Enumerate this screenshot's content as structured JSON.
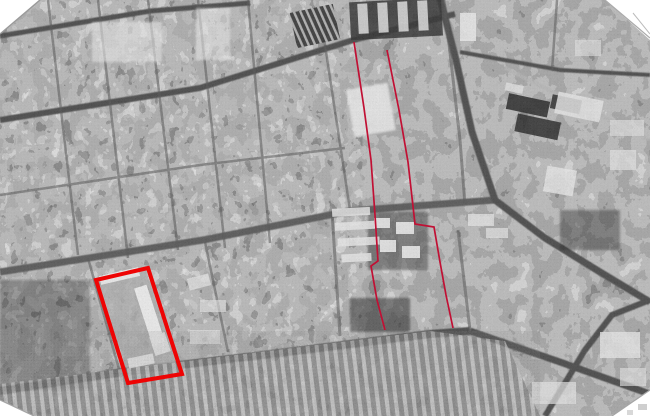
{
  "image": {
    "kind": "grayscale-aerial-photograph",
    "width": 650,
    "height": 416,
    "base_gray": "#8e8e8e",
    "corner_mask_color": "#ffffff"
  },
  "annotations": {
    "highlight_rectangle": {
      "shape": "polygon",
      "points": [
        [
          96,
          280
        ],
        [
          148,
          268
        ],
        [
          182,
          374
        ],
        [
          128,
          383
        ]
      ],
      "stroke": "#ee0404",
      "stroke_width": 4
    },
    "survey_line_left": {
      "shape": "polyline",
      "points": [
        [
          354,
          42
        ],
        [
          364,
          108
        ],
        [
          371,
          160
        ],
        [
          375,
          215
        ],
        [
          378,
          261
        ],
        [
          371,
          266
        ],
        [
          377,
          300
        ],
        [
          385,
          330
        ]
      ],
      "stroke": "#c11034",
      "stroke_width": 1.7
    },
    "survey_line_right": {
      "shape": "polyline",
      "points": [
        [
          387,
          50
        ],
        [
          399,
          110
        ],
        [
          408,
          162
        ],
        [
          415,
          224
        ],
        [
          434,
          227
        ],
        [
          440,
          262
        ],
        [
          446,
          295
        ],
        [
          453,
          328
        ]
      ],
      "stroke": "#c11034",
      "stroke_width": 1.7
    }
  }
}
